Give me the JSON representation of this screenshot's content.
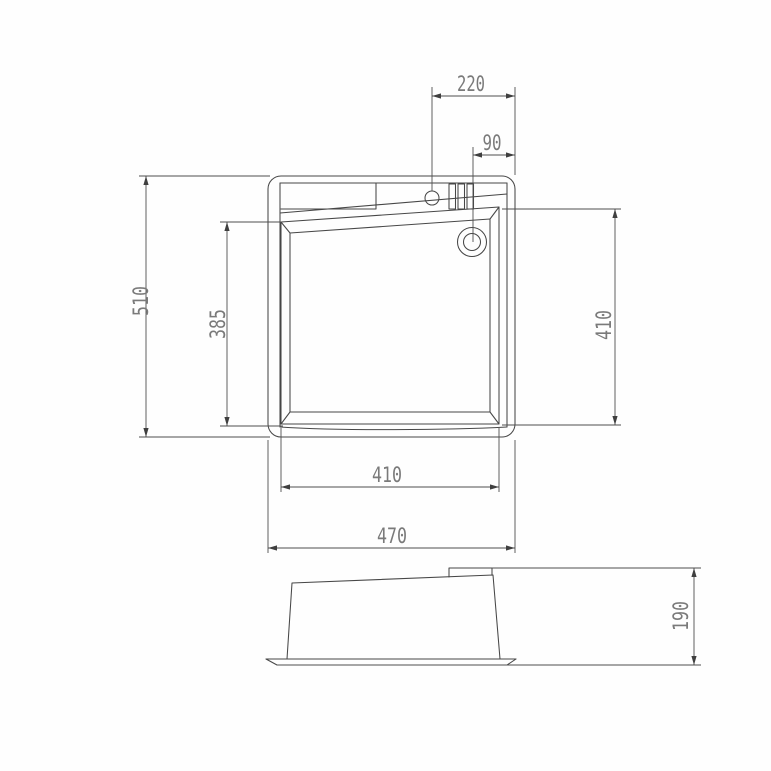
{
  "drawing": {
    "top_view": {
      "dim_faucet_to_edge": "220",
      "dim_drain_to_edge": "90",
      "dim_overall_height": "510",
      "dim_basin_height_left": "385",
      "dim_basin_height_right": "410",
      "dim_basin_width": "410",
      "dim_overall_width": "470"
    },
    "side_view": {
      "dim_mount_depth": "190"
    },
    "colors": {
      "line": "#474747",
      "dimension_line": "#4f4f4f",
      "text": "#7a7a7a",
      "background": "#fefefe"
    }
  }
}
